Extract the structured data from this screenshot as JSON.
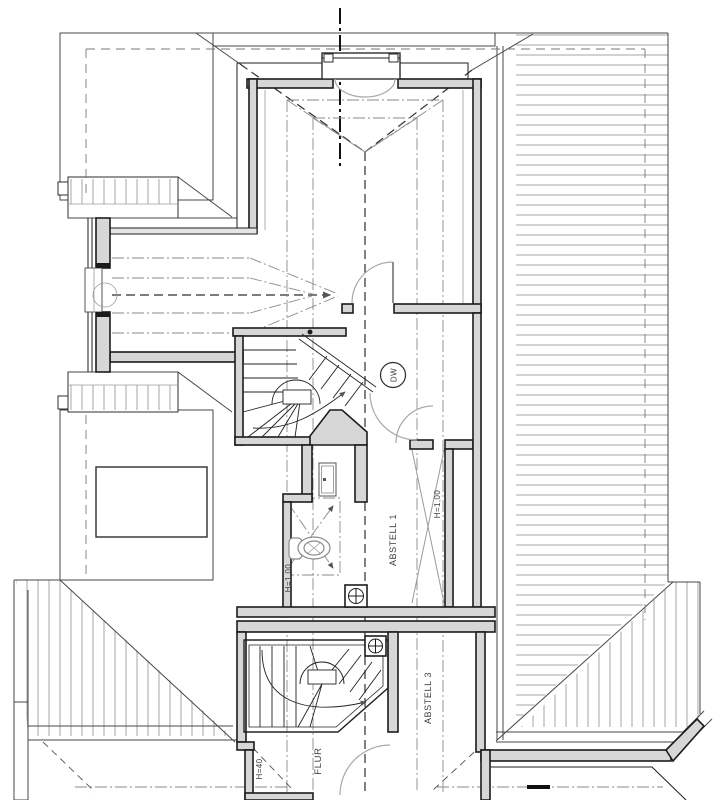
{
  "plan": {
    "labels": {
      "dw": "DW",
      "abstell_1": "ABSTELL 1",
      "abstell_3": "ABSTELL 3",
      "flur": "FLUR",
      "h_100_abstell": "H=1,00",
      "h_100_bath": "H=1,00",
      "h_40": "H=40"
    },
    "symbols": {
      "wc": "wc-toilet-symbol",
      "washbasin": "washbasin-symbol",
      "floor_drain": "floor-drain-symbol",
      "column": "round-column-symbol",
      "stairs": "winder-stair-symbol",
      "door": "door-swing-arc",
      "roof_window": "roof-window-swing"
    },
    "colors": {
      "background": "#ffffff",
      "line": "#1c1c1c",
      "hatch": "#9b9b9b",
      "wall_fill": "#d7d7d7",
      "reference": "#8a8a8a",
      "door_arc": "#a8a8a8",
      "text": "#3c3c3c"
    }
  }
}
